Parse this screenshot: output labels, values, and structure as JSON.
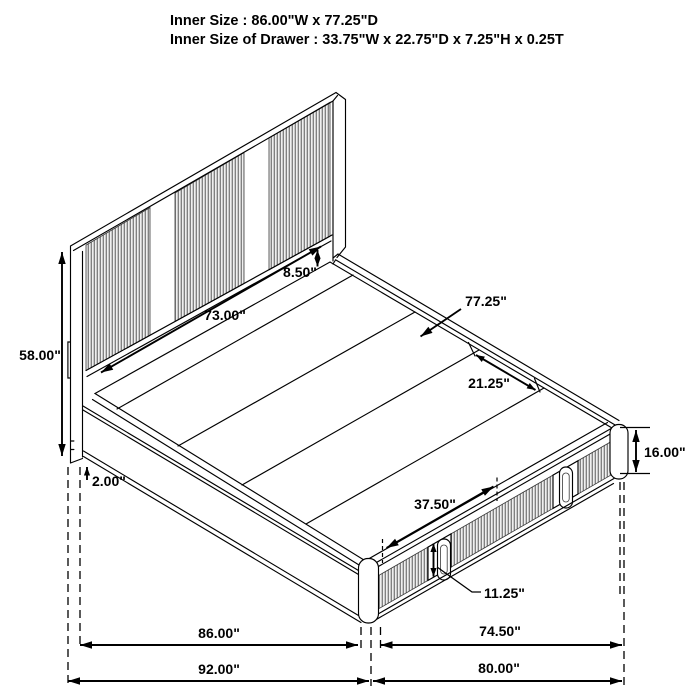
{
  "header": {
    "line1": "Inner Size : 86.00\"W x 77.25\"D",
    "line2": "Inner Size of Drawer : 33.75\"W x 22.75\"D x 7.25\"H x 0.25T"
  },
  "dimensions": {
    "headboard_height": "58.00\"",
    "headboard_inner_width": "73.00\"",
    "headboard_rail_height": "8.50\"",
    "platform_inner_depth": "77.25\"",
    "rail_corner_offset": "21.25\"",
    "footboard_height": "16.00\"",
    "floor_clearance": "2.00\"",
    "drawer_pair_width": "37.50\"",
    "drawer_front_height": "11.25\"",
    "inner_width": "86.00\"",
    "side_span": "74.50\"",
    "overall_width": "92.00\"",
    "overall_depth": "80.00\""
  },
  "colors": {
    "line": "#000000",
    "background": "#ffffff",
    "slat_dark": "#6e6e6e",
    "slat_light": "#efefef"
  }
}
